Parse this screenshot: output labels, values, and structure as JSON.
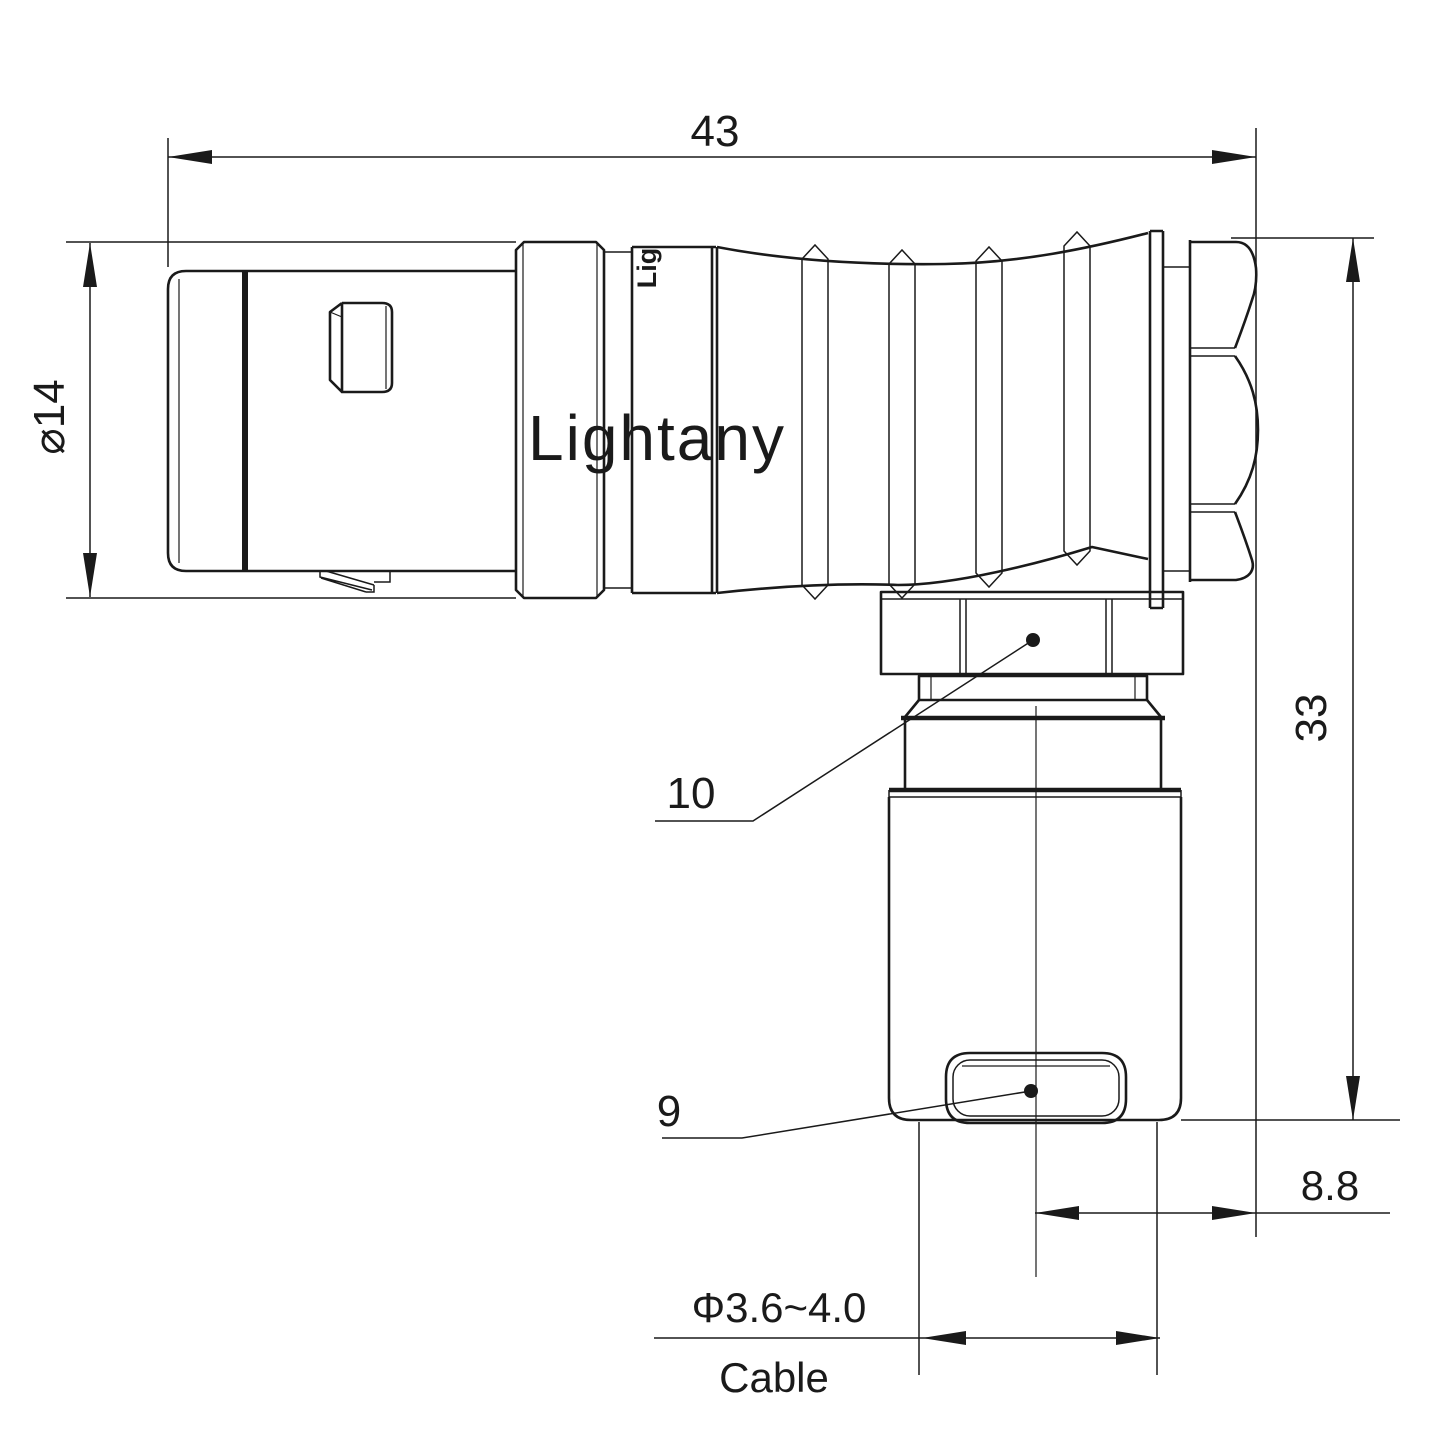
{
  "colors": {
    "ink": "#1a1a1a",
    "background": "#ffffff",
    "watermark": "#f5bcbc"
  },
  "watermark": {
    "text": "Lightany"
  },
  "body_engraving": {
    "text": "Lig"
  },
  "dimensions": {
    "overall_length": "43",
    "front_diameter": "⌀14",
    "overall_height": "33",
    "rear_to_cable_axis": "8.8",
    "cable_diameter_range": "Φ3.6~4.0",
    "cable_label": "Cable"
  },
  "callouts": {
    "coupling_nut_number": "10",
    "cable_entry_number": "9"
  }
}
